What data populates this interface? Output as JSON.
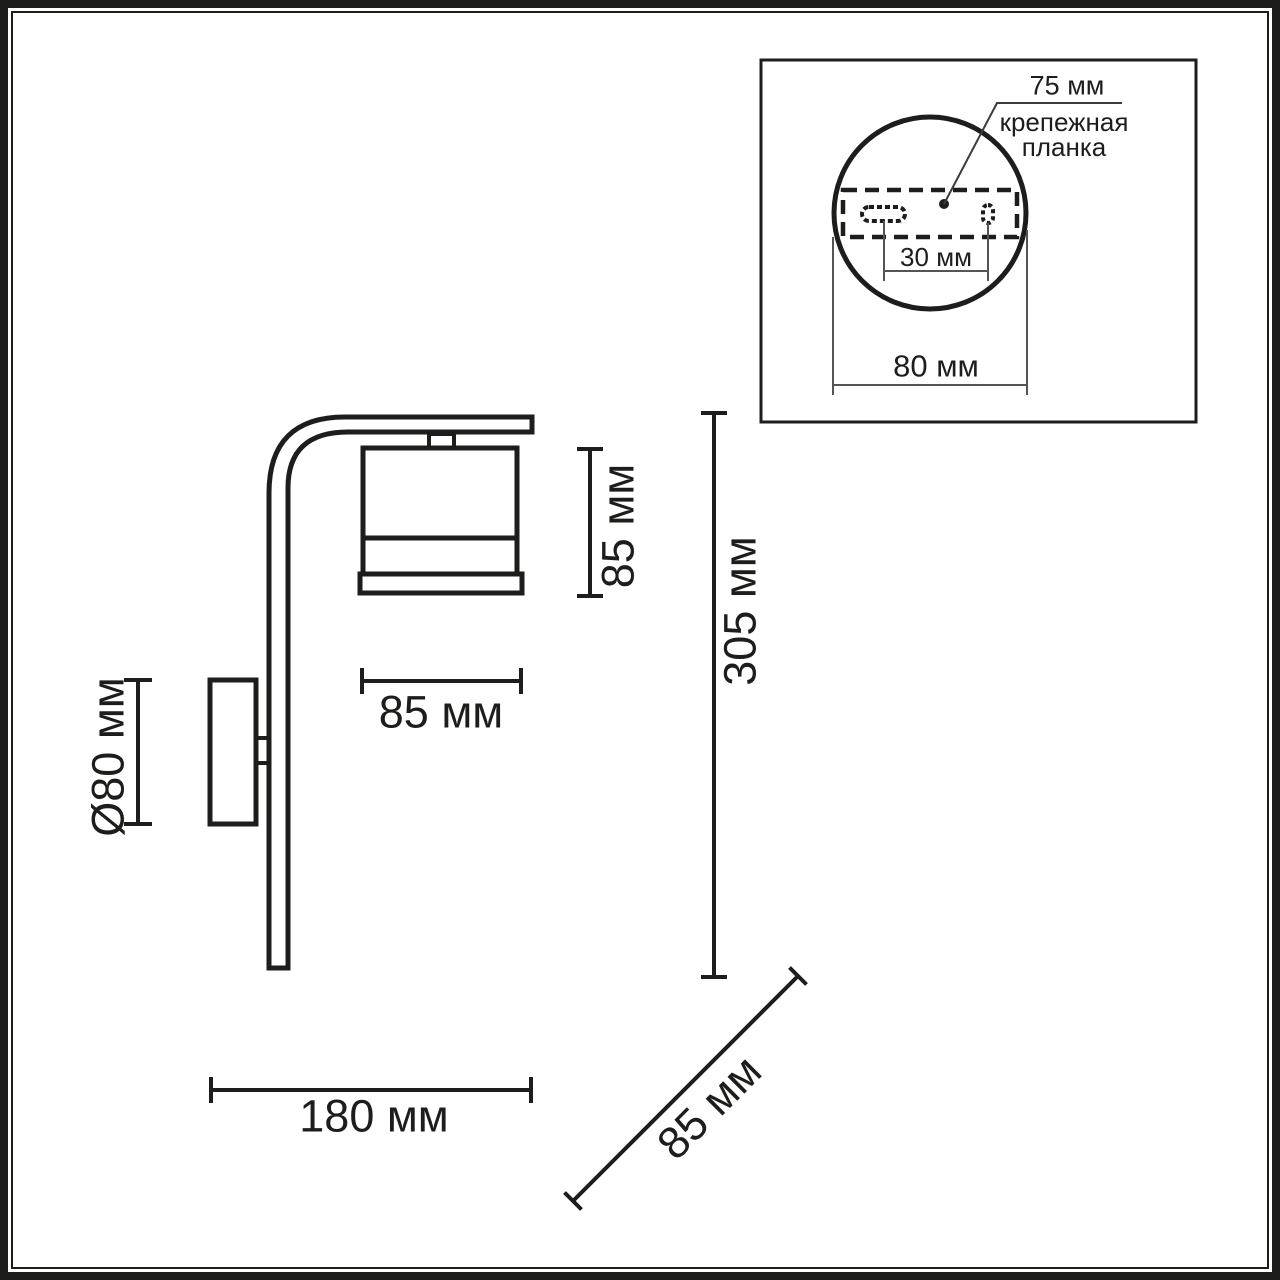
{
  "drawing": {
    "type": "wall-lamp dimensional drawing",
    "units": "мм",
    "colors": {
      "line": "#1d1d1b",
      "thin_line": "#555555",
      "background": "#ffffff"
    },
    "dims": {
      "shade_height": "85 мм",
      "shade_width": "85 мм",
      "base_diameter": "Ø80 мм",
      "total_height": "305 мм",
      "total_depth": "180 мм",
      "shade_depth": "85 мм"
    },
    "inset": {
      "plate_length": "75 мм",
      "plate_name_line1": "крепежная",
      "plate_name_line2": "планка",
      "hole_spacing": "30 мм",
      "base_width": "80 мм"
    }
  }
}
